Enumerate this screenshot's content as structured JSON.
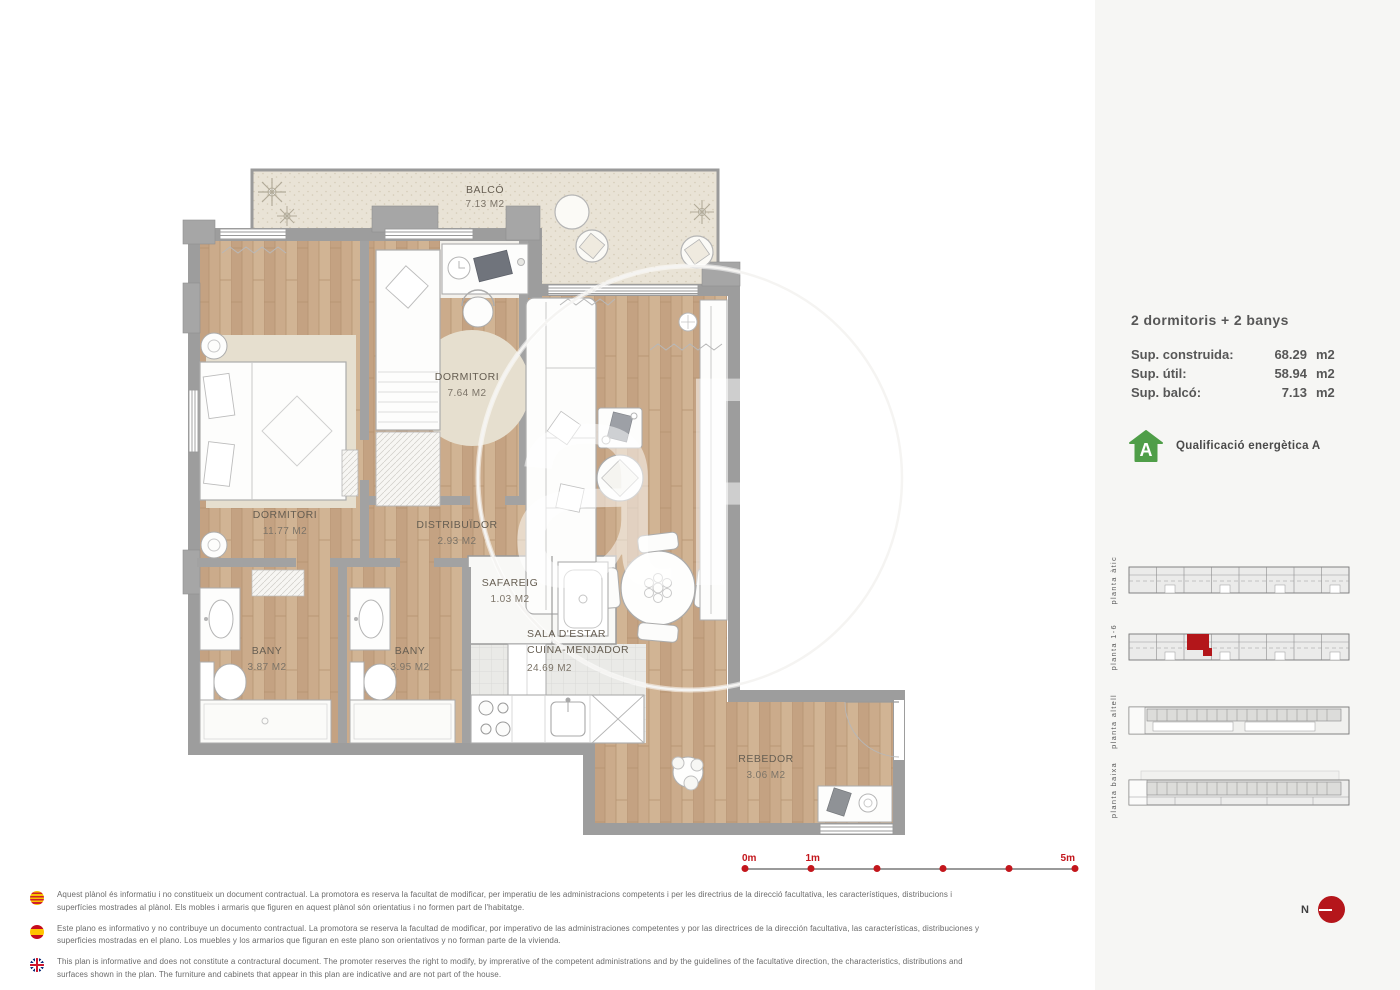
{
  "summary": {
    "title": "2 dormitoris + 2 banys",
    "rows": [
      {
        "label": "Sup. construida:",
        "value": "68.29",
        "unit": "m2"
      },
      {
        "label": "Sup. útil:",
        "value": "58.94",
        "unit": "m2"
      },
      {
        "label": "Sup. balcó:",
        "value": "7.13",
        "unit": "m2"
      }
    ]
  },
  "energy": {
    "label": "Qualificació energètica A",
    "letter": "A"
  },
  "rooms": [
    {
      "name": "BALCÓ",
      "area": "7.13 M2"
    },
    {
      "name": "DORMITORI",
      "area": "7.64 M2"
    },
    {
      "name": "DORMITORI",
      "area": "11.77 M2"
    },
    {
      "name": "DISTRIBUÏDOR",
      "area": "2.93 M2"
    },
    {
      "name": "SAFAREIG",
      "area": "1.03 M2"
    },
    {
      "name": "BANY",
      "area": "3.87 M2"
    },
    {
      "name": "BANY",
      "area": "3.95 M2"
    },
    {
      "name": "SALA D'ESTAR",
      "name2": "CUINA-MENJADOR",
      "area": "24.69 M2"
    },
    {
      "name": "REBEDOR",
      "area": "3.06 M2"
    }
  ],
  "scale_bar": {
    "labels": [
      "0m",
      "1m",
      "5m"
    ]
  },
  "sidebar_plans": [
    {
      "label": "planta àtic",
      "highlighted": false
    },
    {
      "label": "planta 1-6",
      "highlighted": true
    },
    {
      "label": "planta altell",
      "highlighted": false
    },
    {
      "label": "planta baixa",
      "highlighted": false
    }
  ],
  "north": {
    "label": "N"
  },
  "watermark": "aP",
  "disclaimers": [
    {
      "flag": "catalonia-flag",
      "text": "Aquest plànol és informatiu i no constitueix un document contractual. La promotora es reserva la facultat de modificar, per imperatiu de les administracions competents i per les directrius de la direcció facultativa, les característiques, distribucions i superfícies mostrades al plànol. Els mobles i armaris que figuren en aquest plànol són orientatius i no formen part de l'habitatge."
    },
    {
      "flag": "spain-flag",
      "text": "Este plano es informativo y no contribuye un documento contractual. La promotora se reserva la facultad de modificar, por imperativo de las administraciones competentes y por las directrices de la dirección facultativa, las características, distribuciones y superficies mostradas en el plano. Los muebles y los armarios que figuran en este plano son orientativos y no forman parte de la vivienda."
    },
    {
      "flag": "uk-flag",
      "text": "This plan is informative and does not constitute a contractural document. The promoter reserves the right to modify, by imprerative of the competent administrations and by the guidelines of the facultative direction, the characteristics, distributions and surfaces shown in the plan. The furniture and cabinets that appear in this plan are indicative and are not part of the house."
    }
  ],
  "colors": {
    "accent_red": "#bc1318",
    "energy_green": "#4f9e48",
    "wood_floor": "#cbab8b",
    "balcony_floor": "#e9e3d6",
    "wall_gray": "#9d9d9d"
  }
}
